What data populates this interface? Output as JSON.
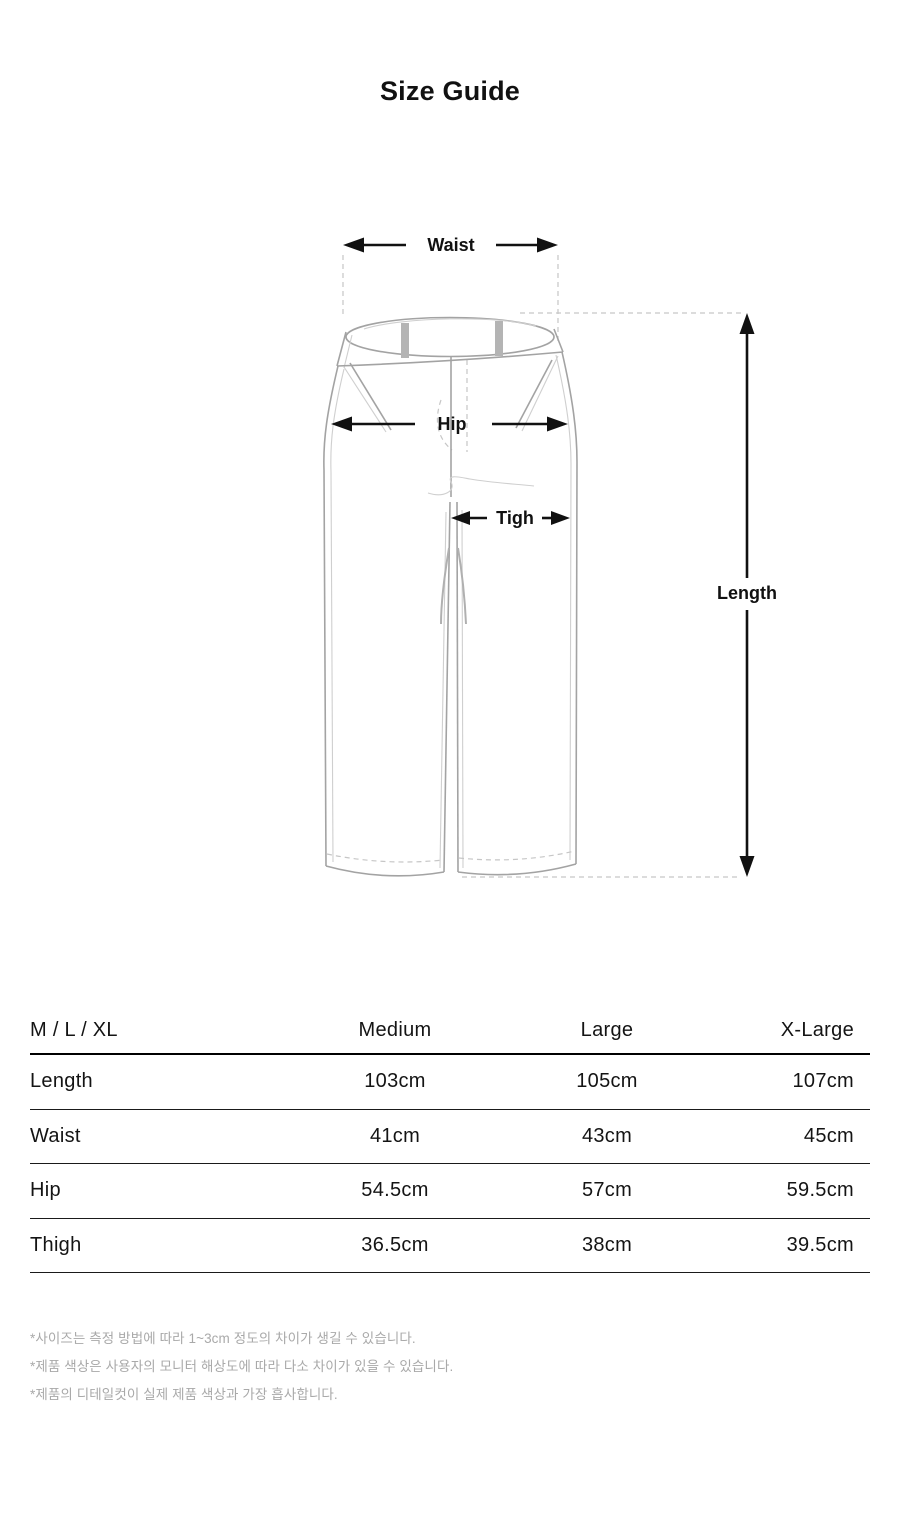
{
  "title": "Size Guide",
  "diagram": {
    "labels": {
      "waist": "Waist",
      "hip": "Hip",
      "thigh": "Tigh",
      "length": "Length"
    }
  },
  "table": {
    "header": {
      "sizes_label": "M / L / XL",
      "columns": [
        "Medium",
        "Large",
        "X-Large"
      ]
    },
    "rows": [
      {
        "label": "Length",
        "values": [
          "103cm",
          "105cm",
          "107cm"
        ]
      },
      {
        "label": "Waist",
        "values": [
          "41cm",
          "43cm",
          "45cm"
        ]
      },
      {
        "label": "Hip",
        "values": [
          "54.5cm",
          "57cm",
          "59.5cm"
        ]
      },
      {
        "label": "Thigh",
        "values": [
          "36.5cm",
          "38cm",
          "39.5cm"
        ]
      }
    ]
  },
  "notes": [
    "*사이즈는 측정 방법에 따라 1~3cm 정도의 차이가 생길 수 있습니다.",
    "*제품 색상은 사용자의 모니터 해상도에 따라 다소 차이가 있을 수 있습니다.",
    "*제품의 디테일컷이 실제 제품 색상과 가장 흡사합니다."
  ],
  "colors": {
    "line_art": "#a3a3a3",
    "arrow": "#111111",
    "belt_loop": "#b4b4b4",
    "note_text": "#a9a9a9",
    "table_rule": "#1a1a1a"
  }
}
